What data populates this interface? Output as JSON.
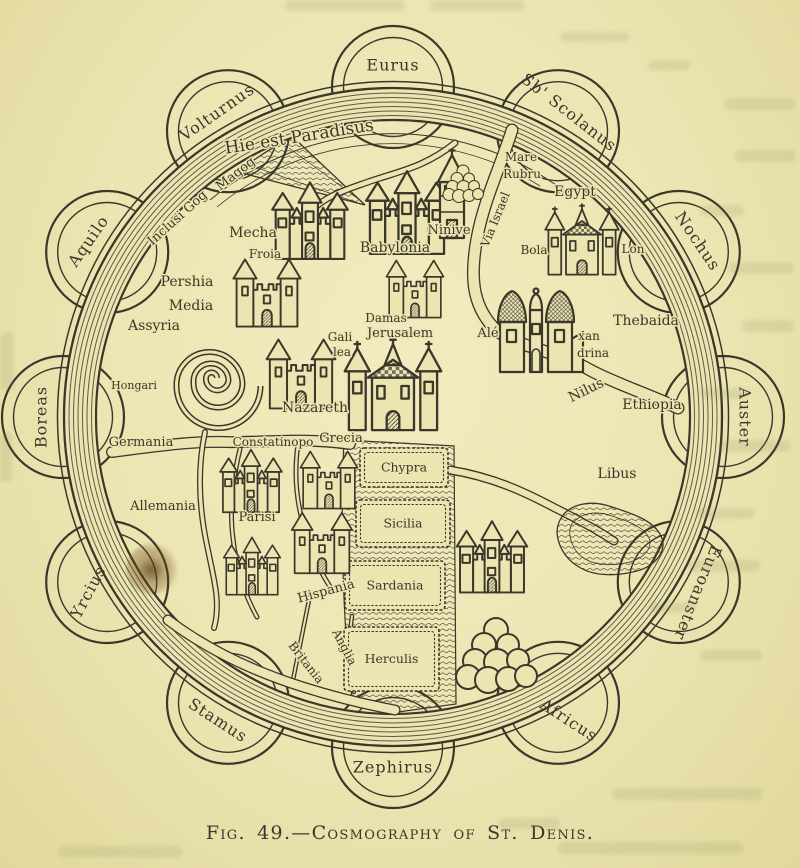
{
  "page": {
    "caption": "Fig. 49.—Cosmography of St. Denis.",
    "paper_color": "#ece5b2",
    "ink_color": "#3b372a"
  },
  "map": {
    "center": {
      "x": 393,
      "y": 417
    },
    "outer_radius": 329,
    "inner_radius": 297,
    "winds": [
      {
        "name": "Eurus",
        "angle": 90,
        "rot": 0
      },
      {
        "name": "Sb' Scolanus",
        "angle": 60,
        "rot": 38
      },
      {
        "name": "Nochus",
        "angle": 30,
        "rot": 56
      },
      {
        "name": "Auster",
        "angle": 0,
        "rot": 90
      },
      {
        "name": "Euroanster",
        "angle": -30,
        "rot": 112
      },
      {
        "name": "Africus",
        "angle": -60,
        "rot": 33
      },
      {
        "name": "Zephirus",
        "angle": -90,
        "rot": 0
      },
      {
        "name": "Stamus",
        "angle": -120,
        "rot": 33
      },
      {
        "name": "Yrcius",
        "angle": -150,
        "rot": -62
      },
      {
        "name": "Boreas",
        "angle": 180,
        "rot": -90
      },
      {
        "name": "Aquilo",
        "angle": 150,
        "rot": -55
      },
      {
        "name": "Volturnus",
        "angle": 120,
        "rot": -35
      }
    ],
    "labels": [
      {
        "text": "Hie est Paradisus",
        "x": 300,
        "y": 142,
        "rot": -9,
        "size": 17
      },
      {
        "text": "Inclusi Gog",
        "x": 180,
        "y": 221,
        "rot": -42,
        "size": 13
      },
      {
        "text": "Magog",
        "x": 238,
        "y": 177,
        "rot": -38,
        "size": 13
      },
      {
        "text": "Mecha",
        "x": 253,
        "y": 237,
        "rot": 0,
        "size": 14
      },
      {
        "text": "Froia",
        "x": 265,
        "y": 258,
        "rot": 0,
        "size": 12
      },
      {
        "text": "Pershia",
        "x": 187,
        "y": 286,
        "rot": 0,
        "size": 14
      },
      {
        "text": "Media",
        "x": 191,
        "y": 310,
        "rot": 0,
        "size": 14
      },
      {
        "text": "Assyria",
        "x": 154,
        "y": 330,
        "rot": 0,
        "size": 14
      },
      {
        "text": "Hongari",
        "x": 134,
        "y": 389,
        "rot": 0,
        "size": 11
      },
      {
        "text": "Babylonia",
        "x": 395,
        "y": 252,
        "rot": 0,
        "size": 14
      },
      {
        "text": "Ninive",
        "x": 449,
        "y": 234,
        "rot": 0,
        "size": 13
      },
      {
        "text": "Mare",
        "x": 521,
        "y": 161,
        "rot": 0,
        "size": 12
      },
      {
        "text": "Rubru",
        "x": 522,
        "y": 178,
        "rot": 0,
        "size": 12
      },
      {
        "text": "Via Israel",
        "x": 499,
        "y": 221,
        "rot": -68,
        "size": 12
      },
      {
        "text": "Egypt",
        "x": 575,
        "y": 196,
        "rot": 0,
        "size": 14
      },
      {
        "text": "Bola",
        "x": 534,
        "y": 254,
        "rot": 0,
        "size": 12
      },
      {
        "text": "Lon",
        "x": 633,
        "y": 253,
        "rot": 0,
        "size": 12
      },
      {
        "text": "Thebaida",
        "x": 646,
        "y": 325,
        "rot": 0,
        "size": 14
      },
      {
        "text": "Alé",
        "x": 488,
        "y": 337,
        "rot": 0,
        "size": 13
      },
      {
        "text": "xan",
        "x": 589,
        "y": 340,
        "rot": 0,
        "size": 12
      },
      {
        "text": "drina",
        "x": 593,
        "y": 357,
        "rot": 0,
        "size": 12
      },
      {
        "text": "Nilus",
        "x": 588,
        "y": 394,
        "rot": -26,
        "size": 14
      },
      {
        "text": "Ethiopia",
        "x": 652,
        "y": 409,
        "rot": 0,
        "size": 14
      },
      {
        "text": "Libus",
        "x": 617,
        "y": 478,
        "rot": 0,
        "size": 14
      },
      {
        "text": "Damas",
        "x": 386,
        "y": 322,
        "rot": 0,
        "size": 12
      },
      {
        "text": "Jerusalem",
        "x": 400,
        "y": 337,
        "rot": 0,
        "size": 13
      },
      {
        "text": "Gali",
        "x": 340,
        "y": 341,
        "rot": 0,
        "size": 12
      },
      {
        "text": "lea",
        "x": 342,
        "y": 356,
        "rot": 0,
        "size": 12
      },
      {
        "text": "Nazareth",
        "x": 315,
        "y": 412,
        "rot": 0,
        "size": 14
      },
      {
        "text": "Germania",
        "x": 141,
        "y": 446,
        "rot": 0,
        "size": 13
      },
      {
        "text": "Allemania",
        "x": 163,
        "y": 510,
        "rot": 0,
        "size": 13
      },
      {
        "text": "Constatinopo",
        "x": 273,
        "y": 446,
        "rot": 0,
        "size": 12
      },
      {
        "text": "Grecia",
        "x": 341,
        "y": 442,
        "rot": 0,
        "size": 13
      },
      {
        "text": "Parisi",
        "x": 257,
        "y": 521,
        "rot": 0,
        "size": 13
      },
      {
        "text": "Hispania",
        "x": 327,
        "y": 595,
        "rot": -15,
        "size": 13
      },
      {
        "text": "Anglia",
        "x": 341,
        "y": 649,
        "rot": 62,
        "size": 12
      },
      {
        "text": "Britania",
        "x": 303,
        "y": 665,
        "rot": 52,
        "size": 12
      }
    ],
    "islands": [
      {
        "label": "Chypra",
        "x": 360,
        "y": 448,
        "w": 88,
        "h": 39
      },
      {
        "label": "Sicilia",
        "x": 356,
        "y": 500,
        "w": 94,
        "h": 47
      },
      {
        "label": "Sardania",
        "x": 345,
        "y": 561,
        "w": 100,
        "h": 49
      },
      {
        "label": "Herculis",
        "x": 344,
        "y": 627,
        "w": 95,
        "h": 64
      }
    ],
    "buildings": [
      {
        "name": "mecha-castle",
        "type": "castleB",
        "x": 310,
        "y": 222,
        "s": 0.88
      },
      {
        "name": "froia-castle",
        "type": "castleA",
        "x": 267,
        "y": 293,
        "s": 0.8
      },
      {
        "name": "babylonia-castle",
        "type": "castleB",
        "x": 407,
        "y": 214,
        "s": 0.95
      },
      {
        "name": "ninive-tower",
        "type": "towerA",
        "x": 452,
        "y": 196,
        "s": 1
      },
      {
        "name": "damas-castle",
        "type": "castleA",
        "x": 415,
        "y": 289,
        "s": 0.68
      },
      {
        "name": "jerusalem-castle",
        "type": "churchA",
        "x": 393,
        "y": 386,
        "s": 1.05
      },
      {
        "name": "nazareth-castle",
        "type": "castleA",
        "x": 301,
        "y": 374,
        "s": 0.82
      },
      {
        "name": "egypt-castle",
        "type": "churchA",
        "x": 582,
        "y": 241,
        "s": 0.8
      },
      {
        "name": "alexandrina-castle",
        "type": "domesA",
        "x": 536,
        "y": 330,
        "s": 1
      },
      {
        "name": "constantinople-castle",
        "type": "castleB",
        "x": 251,
        "y": 482,
        "s": 0.72
      },
      {
        "name": "grecia-castle",
        "type": "castleA",
        "x": 329,
        "y": 480,
        "s": 0.68
      },
      {
        "name": "parisi-castle",
        "type": "castleB",
        "x": 252,
        "y": 567,
        "s": 0.66
      },
      {
        "name": "hispania-castle",
        "type": "castleA",
        "x": 322,
        "y": 543,
        "s": 0.72
      },
      {
        "name": "africa-castle",
        "type": "castleB",
        "x": 492,
        "y": 558,
        "s": 0.82
      },
      {
        "name": "grove",
        "type": "grove",
        "x": 498,
        "y": 648,
        "s": 1
      },
      {
        "name": "paradise-trees",
        "type": "grove",
        "x": 464,
        "y": 180,
        "s": 0.5
      }
    ]
  }
}
